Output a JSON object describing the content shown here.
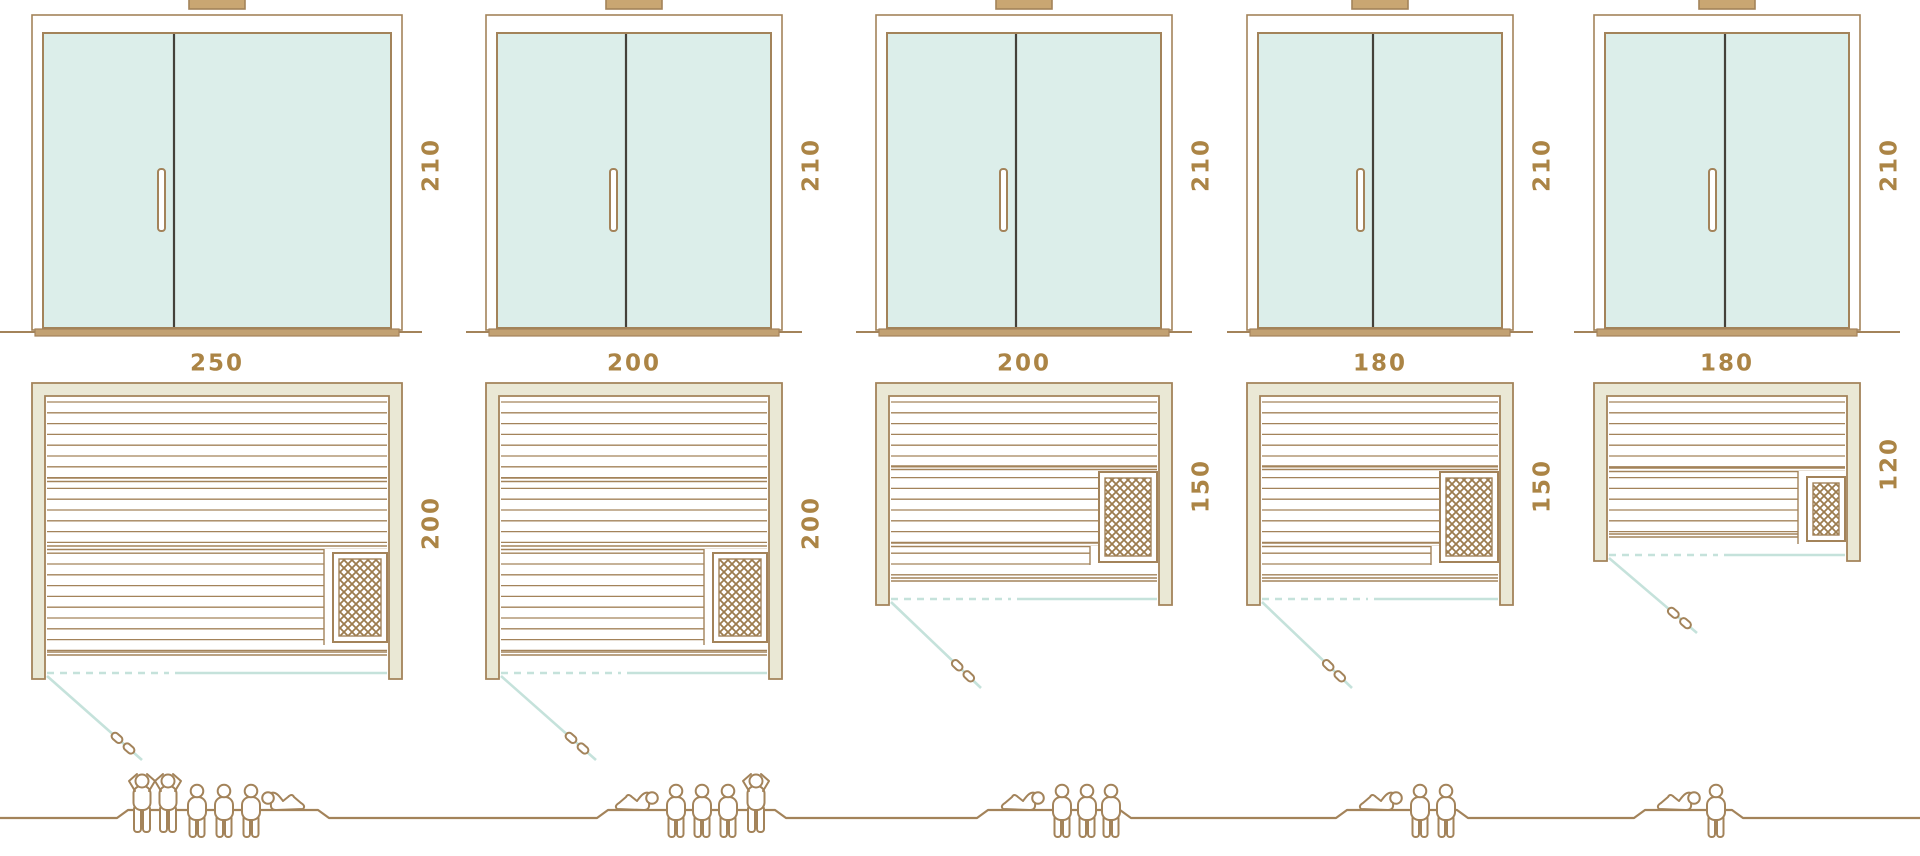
{
  "diagram": {
    "title": "sauna size comparison",
    "views": [
      "front-elevation",
      "floor-plan",
      "capacity-figures"
    ],
    "units_shown": "dimension numbers only"
  },
  "colors": {
    "outline_brown": "#a3835a",
    "label_brown": "#ab8445",
    "glass_mint": "#dceeea",
    "frame_beige": "#eae8d5",
    "sill_tan": "#c2a172",
    "chimney_tan": "#c9a672",
    "door_glass_teal": "#c5e2db",
    "divider_dark": "#44413a",
    "lattice_brown": "#9c7c4e",
    "background": "#ffffff"
  },
  "saunas": [
    {
      "width": 250,
      "depth": 200,
      "height": 210,
      "capacity": 6,
      "figures": [
        "standing",
        "standing",
        "seated",
        "seated",
        "seated",
        "lying"
      ]
    },
    {
      "width": 200,
      "depth": 200,
      "height": 210,
      "capacity": 5,
      "figures": [
        "lying",
        "seated",
        "seated",
        "seated",
        "standing"
      ]
    },
    {
      "width": 200,
      "depth": 150,
      "height": 210,
      "capacity": 4,
      "figures": [
        "lying",
        "seated",
        "seated",
        "seated"
      ]
    },
    {
      "width": 180,
      "depth": 150,
      "height": 210,
      "capacity": 3,
      "figures": [
        "lying",
        "seated",
        "seated"
      ]
    },
    {
      "width": 180,
      "depth": 120,
      "height": 210,
      "capacity": 2,
      "figures": [
        "lying",
        "seated"
      ]
    }
  ],
  "icons": {
    "person-standing-icon": "standing bather outline figure",
    "person-seated-icon": "seated bather outline figure",
    "person-lying-icon": "reclining bather outline figure",
    "heater-icon": "sauna heater box with crosshatch lattice",
    "door-handle-icon": "vertical glass-door handle",
    "chimney-icon": "roof vent stub",
    "door-swing-icon": "open door diagonal with handle"
  }
}
